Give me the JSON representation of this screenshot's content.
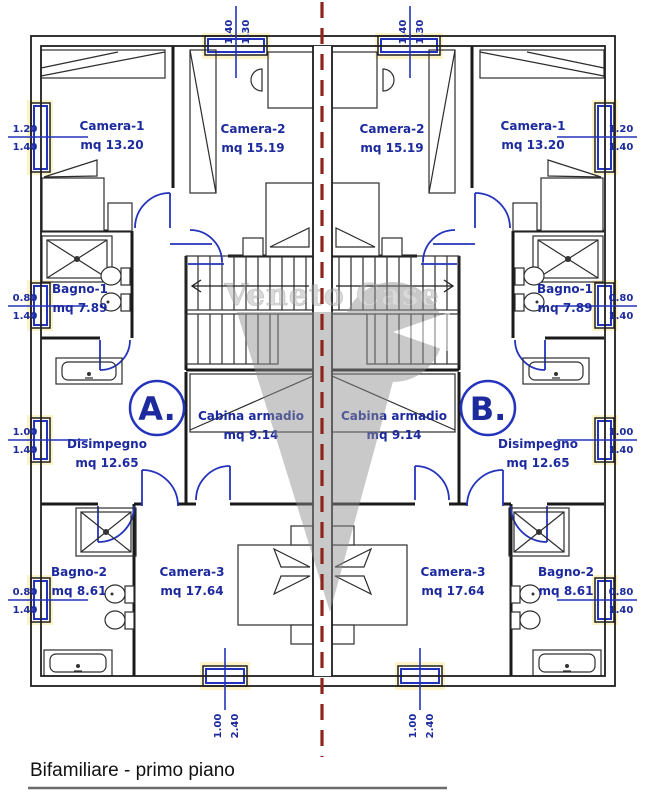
{
  "meta": {
    "title": "Bifamiliare - primo piano"
  },
  "watermark": {
    "text": "Veneto Case"
  },
  "units": {
    "a": "A.",
    "b": "B."
  },
  "rooms": {
    "camera1": {
      "name": "Camera-1",
      "area": "mq 13.20"
    },
    "camera2": {
      "name": "Camera-2",
      "area": "mq 15.19"
    },
    "camera3": {
      "name": "Camera-3",
      "area": "mq 17.64"
    },
    "bagno1": {
      "name": "Bagno-1",
      "area": "mq 7.89"
    },
    "bagno2": {
      "name": "Bagno-2",
      "area": "mq 8.61"
    },
    "disimpegno": {
      "name": "Disimpegno",
      "area": "mq 12.65"
    },
    "cabina": {
      "name": "Cabina armadio",
      "area": "mq 9.14"
    }
  },
  "dimensions": {
    "win_130": {
      "w": "1.30",
      "h": "1.40"
    },
    "win_120": {
      "w": "1.20",
      "h": "1.40"
    },
    "win_100": {
      "w": "1.00",
      "h": "1.40"
    },
    "win_080": {
      "w": "0.80",
      "h": "1.40"
    },
    "win_240": {
      "w": "1.00",
      "h": "2.40"
    }
  },
  "colors": {
    "label_blue": "#1c2a9e",
    "drawing_blue": "#2433bb",
    "wall_black": "#1f1f1f",
    "divider_red": "#8e241c",
    "watermark_gray": "#8f8f8f",
    "window_highlight": "#fcf4c8"
  }
}
